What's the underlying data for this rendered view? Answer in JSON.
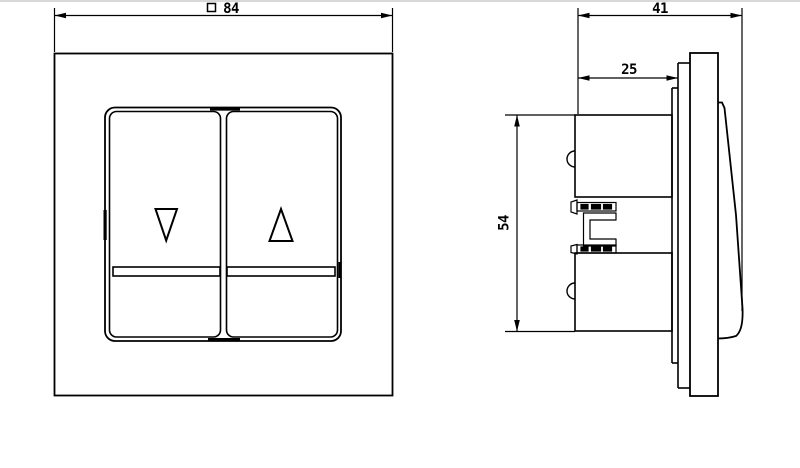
{
  "drawing": {
    "type": "technical-orthographic-views",
    "subject": "two-button rocker switch with up and down arrows, front view and side section view",
    "colors": {
      "background": "#ffffff",
      "line": "#000000",
      "top_edge": "#d8d8d8"
    }
  },
  "dimensions": {
    "front_width": {
      "symbol": "□",
      "value": "84"
    },
    "total_depth": {
      "value": "41"
    },
    "insert_depth": {
      "value": "25"
    },
    "insert_height": {
      "value": "54"
    }
  },
  "icons": {
    "arrow_down_symbol": "▽",
    "arrow_up_symbol": "△",
    "square_symbol": "□"
  }
}
